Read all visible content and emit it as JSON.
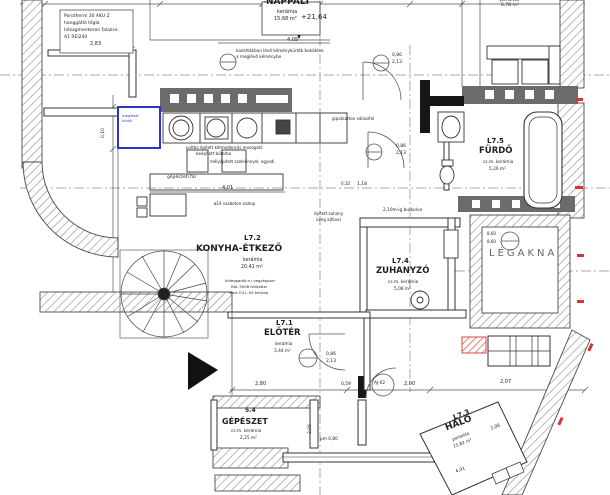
{
  "plan_title": "L7 lakás alaprajz",
  "rooms": {
    "nappali": {
      "id": "",
      "name": "NAPPALI",
      "finish": "kerámia",
      "area": "15,68 m²"
    },
    "konyha": {
      "id": "L7.2",
      "name": "KONYHA-ÉTKEZŐ",
      "finish": "kerámia",
      "area": "20,41 m²"
    },
    "eloter": {
      "id": "L7.1",
      "name": "ELŐTÉR",
      "finish": "kerámia",
      "area": "3,44 m²"
    },
    "zuhanyzo": {
      "id": "L7.4",
      "name": "ZUHANYZÓ",
      "finish": "cs.m. kerámia",
      "area": "5,08 m²"
    },
    "furdo": {
      "id": "L7.5",
      "name": "FÜRDŐ",
      "finish": "cs.m. kerámia",
      "area": "5,26 m²"
    },
    "halo": {
      "id": "L7.3",
      "name": "HÁLÓ",
      "finish": "parketta",
      "area": "15,82 m²"
    },
    "gepeszet": {
      "id": "5.4",
      "name": "GÉPÉSZET",
      "finish": "cs.m. kerámia",
      "area": "2,25 m²"
    },
    "legakna": {
      "name": "LÉGAKNA"
    },
    "erkely": {
      "finish": "parketta",
      "area": "6,78 m²"
    }
  },
  "levels": {
    "floor": "+21,64",
    "legakna_1": "8,60",
    "legakna_2": "8,60"
  },
  "notes": {
    "porotherm": [
      "Porotherm 30 AKU Z",
      "hanggátló tégla",
      "hézagmentesen falazva",
      "A1 REI240"
    ],
    "chimney": [
      "kazettákban lévő kéménykürtők bekötése",
      "a meglévő kéménybe"
    ],
    "gipszkarton": "gipszkarton válaszfal",
    "kitchen": [
      "pultba épített kétmedencés mosogató",
      "beépített bútorba",
      "mélyépített szekrénnyel, egyedi"
    ],
    "gepfal": "gépészeti fal",
    "oszlop": "ø14 vasbeton oszlop",
    "konyha_note": [
      "hidegpadló e-i vegyépszer",
      "RAL 9006 felülettel",
      "lásd: E4 L-03 tervlap"
    ],
    "zuhany": [
      "épített zuhany",
      "üveg ajtóval"
    ],
    "burkolva": "2,10m-ig burkolva",
    "kurto": [
      "meglévő",
      "kürtő"
    ],
    "pm": "pm 0,80"
  },
  "dims": {
    "porotherm_len": "2,83",
    "nappali_w": "4,05",
    "konyha_w": "4,01",
    "kis": "0,10",
    "door_w": "0,86",
    "door_h": "2,13",
    "koz": "1,18",
    "eloter_w": "2,80",
    "eloter_gap": "0,59",
    "gepeszet_w": "2,00",
    "halo_w": "2,07",
    "gepeszet_h": "2,05",
    "halo_len": "2,06",
    "halo_len2": "4,01"
  },
  "door_tag": "AJ-02",
  "colors": {
    "wall_line": "#3a3a3a",
    "hatch": "#9a9a9a",
    "dark_band": "#6b6b6b",
    "accent_blue": "#2a35c8",
    "accent_red": "#d63333"
  }
}
